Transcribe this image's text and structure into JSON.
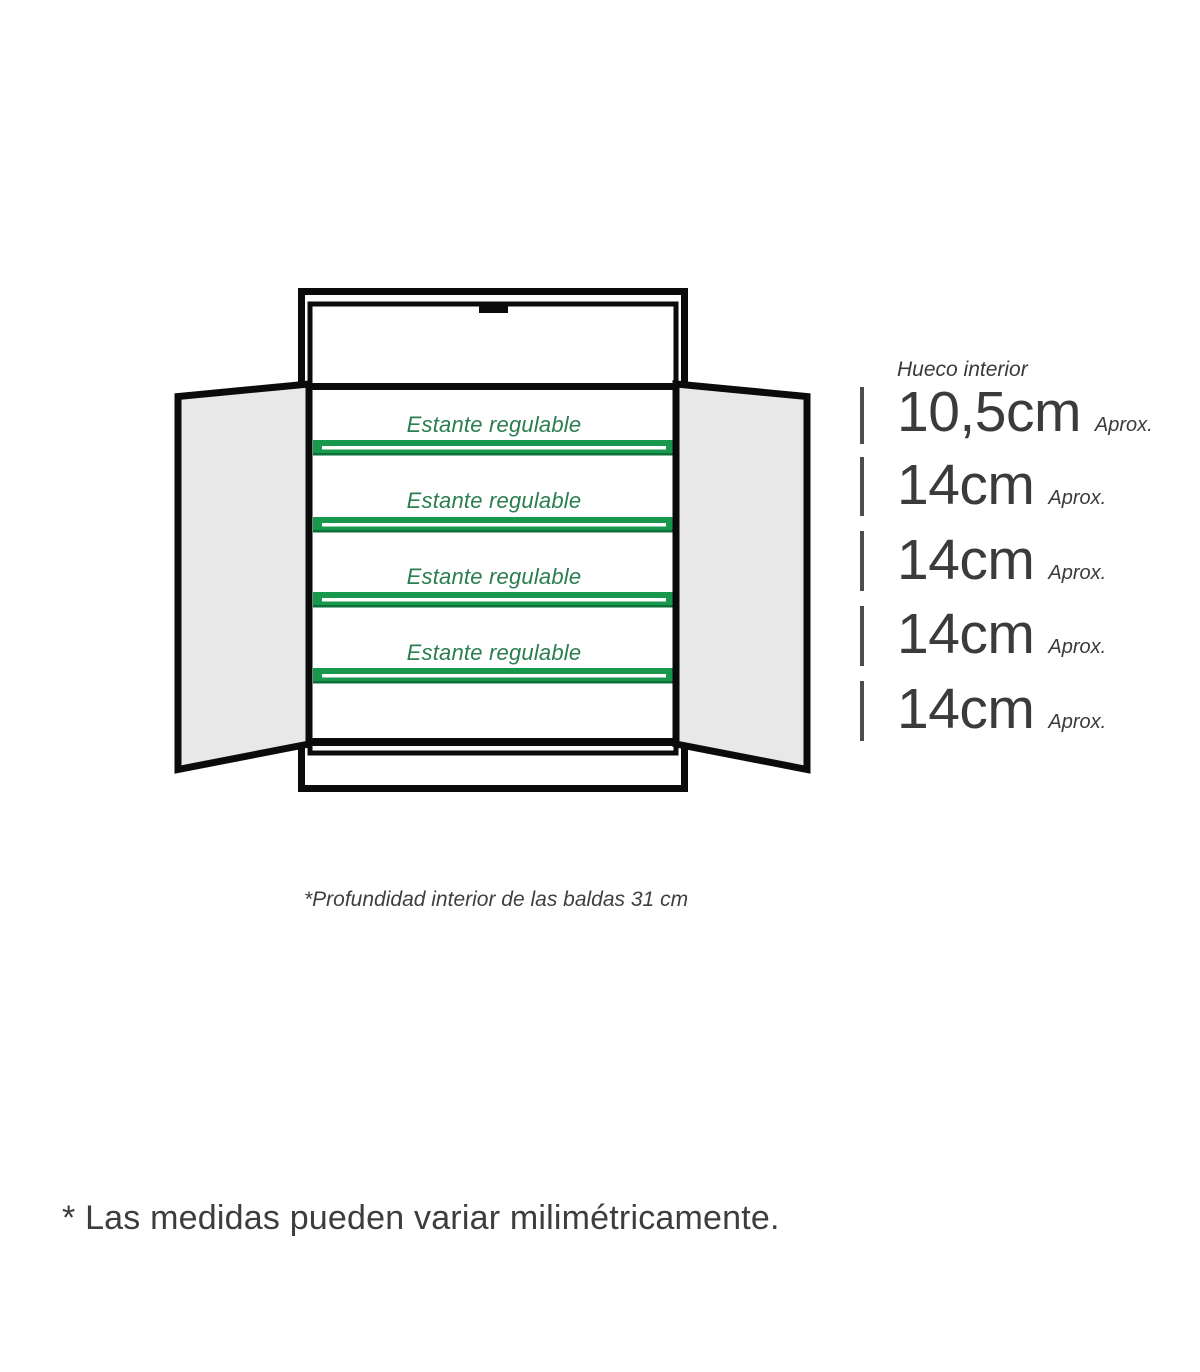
{
  "cabinet": {
    "shelves": [
      {
        "label": "Estante regulable"
      },
      {
        "label": "Estante regulable"
      },
      {
        "label": "Estante regulable"
      },
      {
        "label": "Estante regulable"
      }
    ]
  },
  "measurements": {
    "header": "Hueco interior",
    "rows": [
      {
        "size": "10,5cm",
        "approx": "Aprox."
      },
      {
        "size": "14cm",
        "approx": "Aprox."
      },
      {
        "size": "14cm",
        "approx": "Aprox."
      },
      {
        "size": "14cm",
        "approx": "Aprox."
      },
      {
        "size": "14cm",
        "approx": "Aprox."
      }
    ]
  },
  "notes": {
    "depth": "*Profundidad interior de las baldas 31 cm",
    "disclaimer": "* Las medidas pueden variar milimétricamente."
  },
  "colors": {
    "shelf_green": "#17984c",
    "shelf_green_dark": "#0d6f38",
    "label_green": "#2a7e4f",
    "door_gray": "#e8e8e8",
    "line_black": "#0b0b0b",
    "tick_gray": "#4d4d4d",
    "text_dark": "#3b3b3b"
  }
}
